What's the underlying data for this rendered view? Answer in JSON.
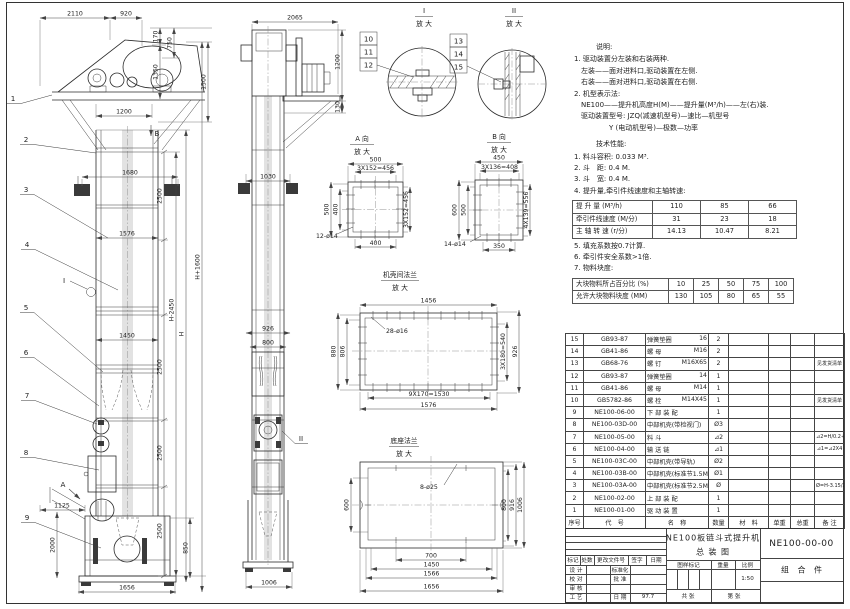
{
  "front": {
    "d_2110": "2110",
    "d_920": "920",
    "d_170": "170",
    "d_750": "750",
    "d_1350": "1350",
    "d_1500": "1500",
    "d_1200": "1200",
    "d_1680": "1680",
    "d_1576": "1576",
    "d_1450": "1450",
    "seg": "2500",
    "d_hm": "H-2450",
    "d_h": "H",
    "d_hp": "H+1600",
    "d_1125": "1125",
    "d_2000": "2000",
    "d_850": "850",
    "d_1656": "1656",
    "balloons": [
      "1",
      "2",
      "3",
      "4",
      "5",
      "6",
      "7",
      "8",
      "9"
    ],
    "marker_a": "A",
    "marker_b": "B",
    "marker_i": "I"
  },
  "side": {
    "d_2065": "2065",
    "d_1200": "1200",
    "d_130": "130",
    "d_1030": "1030",
    "d_926": "926",
    "d_800": "800",
    "d_1006": "1006",
    "marker_ii": "II"
  },
  "detail1": {
    "num": "I",
    "zoom": "放 大",
    "balloons": [
      "10",
      "11",
      "12"
    ]
  },
  "detail2": {
    "num": "II",
    "zoom": "放 大",
    "balloons": [
      "13",
      "14",
      "15"
    ]
  },
  "viewA": {
    "t": "A 向",
    "zoom": "放 大",
    "top1": "500",
    "top2": "3X152=456",
    "l1": "500",
    "l2": "400",
    "r1": "3X152=456",
    "b1": "400",
    "holes": "12-ø14"
  },
  "viewB": {
    "t": "B 向",
    "zoom": "放 大",
    "top1": "450",
    "top2": "3X136=408",
    "l1": "600",
    "l2": "500",
    "r1": "4X139=556",
    "b1": "350",
    "holes": "14-ø14"
  },
  "viewF": {
    "t": "机壳间法兰",
    "zoom": "放 大",
    "top1": "1456",
    "l1": "880",
    "l2": "806",
    "r1": "3X180=540",
    "r2": "926",
    "b1": "9X170=1530",
    "b2": "1576",
    "holes": "28-ø16"
  },
  "viewD": {
    "t": "底座法兰",
    "zoom": "放 大",
    "l1": "600",
    "r1": "800",
    "r2": "916",
    "r3": "1006",
    "b1": "700",
    "b2": "1450",
    "b3": "1566",
    "b4": "1656",
    "holes": "8-ø25"
  },
  "notes": {
    "heading": "说明:",
    "lines": [
      {
        "t": "1. 驱动装置分左装和右装两种."
      },
      {
        "t": "　左装——面对进料口,驱动装置在左侧."
      },
      {
        "t": "　右装——面对进料口,驱动装置在右侧."
      },
      {
        "t": "2. 机型表示法:"
      },
      {
        "t": "　NE100——提升机高度H(M)——提升量(M³/h)——左(右)装."
      },
      {
        "t": "　驱动装置型号: JZQ(减速机型号)—速比—机型号"
      },
      {
        "t": "　　　　　Y (电动机型号)—极数—功率"
      }
    ]
  },
  "tech": {
    "heading": "技术性能:",
    "pre": [
      {
        "t": "1. 料斗容积: 0.033 M³."
      },
      {
        "t": "2. 斗　距: 0.4 M."
      },
      {
        "t": "3. 斗　宽: 0.4 M."
      },
      {
        "t": "4. 提升量,牵引件线速度和主轴转速:"
      }
    ],
    "post": [
      {
        "t": "5. 填充系数按0.7计算."
      },
      {
        "t": "6. 牵引件安全系数>1倍."
      },
      {
        "t": "7. 物料块度:"
      }
    ]
  },
  "perf": {
    "rows": [
      {
        "label": "提 升 量 (M³/h)",
        "a": "110",
        "b": "85",
        "c": "66"
      },
      {
        "label": "牵引件线速度 (M/分)",
        "a": "31",
        "b": "23",
        "c": "18"
      },
      {
        "label": "主 轴 转 速 (r/分)",
        "a": "14.13",
        "b": "10.47",
        "c": "8.21"
      }
    ]
  },
  "lump": {
    "rows": [
      {
        "label": "大块物料所占百分比 (%)",
        "a": "10",
        "b": "25",
        "c": "50",
        "d": "75",
        "e": "100"
      },
      {
        "label": "允许大块物料块度 (MM)",
        "a": "130",
        "b": "105",
        "c": "80",
        "d": "65",
        "e": "55"
      }
    ]
  },
  "parts": {
    "headers": [
      "序号",
      "代　号",
      "名　称",
      "数量",
      "材　料",
      "单重",
      "总重",
      "备 注"
    ],
    "rows": [
      {
        "no": "15",
        "code": "GB93-87",
        "name": "弹簧垫圈",
        "spec": "16",
        "qty": "2",
        "mat": "",
        "uw": "",
        "tw": "",
        "rem": ""
      },
      {
        "no": "14",
        "code": "GB41-86",
        "name": "螺 母",
        "spec": "M16",
        "qty": "2",
        "mat": "",
        "uw": "",
        "tw": "",
        "rem": ""
      },
      {
        "no": "13",
        "code": "GB68-76",
        "name": "螺 钉",
        "spec": "M16X65",
        "qty": "2",
        "mat": "",
        "uw": "",
        "tw": "",
        "rem": "见发货清单"
      },
      {
        "no": "12",
        "code": "GB93-87",
        "name": "弹簧垫圈",
        "spec": "14",
        "qty": "1",
        "mat": "",
        "uw": "",
        "tw": "",
        "rem": ""
      },
      {
        "no": "11",
        "code": "GB41-86",
        "name": "螺 母",
        "spec": "M14",
        "qty": "1",
        "mat": "",
        "uw": "",
        "tw": "",
        "rem": ""
      },
      {
        "no": "10",
        "code": "GB5782-86",
        "name": "螺 栓",
        "spec": "M14X45",
        "qty": "1",
        "mat": "",
        "uw": "",
        "tw": "",
        "rem": "见发货清单"
      },
      {
        "no": "9",
        "code": "NE100-06-00",
        "name": "下 部 装 配",
        "spec": "",
        "qty": "1",
        "mat": "",
        "uw": "",
        "tw": "",
        "rem": ""
      },
      {
        "no": "8",
        "code": "NE100-03D-00",
        "name": "中部机壳(带检视门)",
        "spec": "",
        "qty": "Ø3",
        "mat": "",
        "uw": "",
        "tw": "",
        "rem": ""
      },
      {
        "no": "7",
        "code": "NE100-05-00",
        "name": "料 斗",
        "spec": "",
        "qty": "⊿2",
        "mat": "",
        "uw": "",
        "tw": "",
        "rem": "⊿2=H/0.2+5.75"
      },
      {
        "no": "6",
        "code": "NE100-04-00",
        "name": "输 送 链",
        "spec": "",
        "qty": "⊿1",
        "mat": "",
        "uw": "",
        "tw": "",
        "rem": "⊿1=⊿2X4"
      },
      {
        "no": "5",
        "code": "NE100-03C-00",
        "name": "中部机壳(带导轨)",
        "spec": "",
        "qty": "Ø2",
        "mat": "",
        "uw": "",
        "tw": "",
        "rem": ""
      },
      {
        "no": "4",
        "code": "NE100-03B-00",
        "name": "中部机壳(标准节1.5M,1M)",
        "spec": "",
        "qty": "Ø1",
        "mat": "",
        "uw": "",
        "tw": "",
        "rem": ""
      },
      {
        "no": "3",
        "code": "NE100-03A-00",
        "name": "中部机壳(标准节2.5M)",
        "spec": "",
        "qty": "Ø",
        "mat": "",
        "uw": "",
        "tw": "",
        "rem": "Ø=H-3.15/2.5"
      },
      {
        "no": "2",
        "code": "NE100-02-00",
        "name": "上 部 装 配",
        "spec": "",
        "qty": "1",
        "mat": "",
        "uw": "",
        "tw": "",
        "rem": ""
      },
      {
        "no": "1",
        "code": "NE100-01-00",
        "name": "驱 动 装 置",
        "spec": "",
        "qty": "1",
        "mat": "",
        "uw": "",
        "tw": "",
        "rem": ""
      }
    ]
  },
  "titleblock": {
    "title1": "NE100板链斗式提升机",
    "title2": "总  装  图",
    "drawing_no": "NE100-00-00",
    "part_type": "组 合 件",
    "rev1": "标记",
    "rev2": "处数",
    "rev3": "更改文件号",
    "rev4": "签字",
    "rev5": "日期",
    "r1l": "设 计",
    "r2l": "校 对",
    "r3l": "审 核",
    "r4l": "工 艺",
    "r1r": "标准化",
    "r2r": "批 准",
    "r4r": "日 期",
    "r4v": "97.7",
    "s1": "图样标记",
    "s2": "重量",
    "s3": "比例",
    "scale": "1:50",
    "b1": "共  张",
    "b2": "第  张"
  }
}
